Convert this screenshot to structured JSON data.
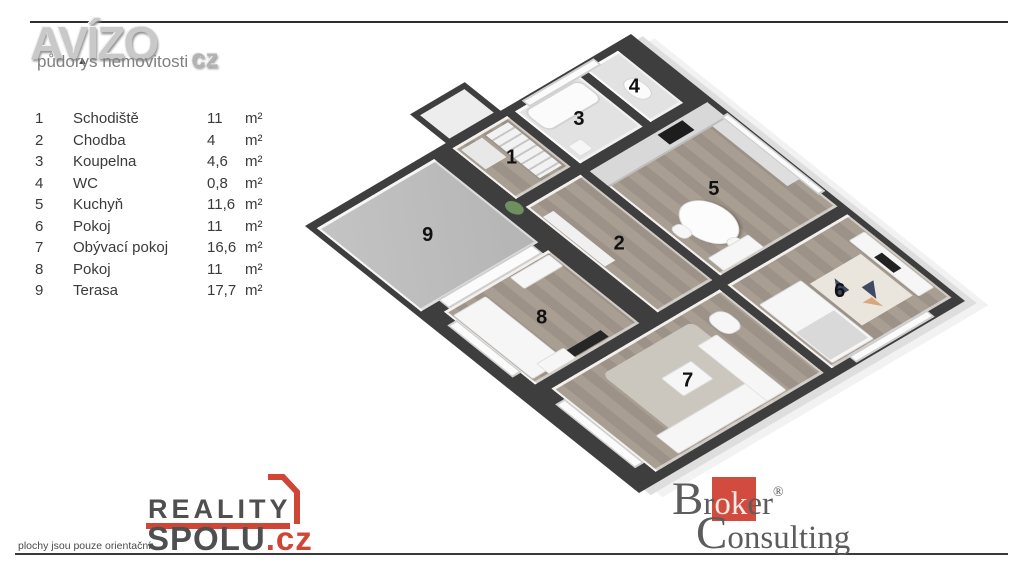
{
  "header": {
    "brand": "AVÍZO",
    "brand_suffix": "cz",
    "subtitle": "půdorys nemovitosti",
    "accent_triangle": "▲"
  },
  "legend": {
    "rows": [
      {
        "num": "1",
        "name": "Schodiště",
        "value": "11",
        "unit": "m²"
      },
      {
        "num": "2",
        "name": "Chodba",
        "value": "4",
        "unit": "m²"
      },
      {
        "num": "3",
        "name": "Koupelna",
        "value": "4,6",
        "unit": "m²"
      },
      {
        "num": "4",
        "name": "WC",
        "value": "0,8",
        "unit": "m²"
      },
      {
        "num": "5",
        "name": "Kuchyň",
        "value": "11,6",
        "unit": "m²"
      },
      {
        "num": "6",
        "name": "Pokoj",
        "value": "11",
        "unit": "m²"
      },
      {
        "num": "7",
        "name": "Obývací pokoj",
        "value": "16,6",
        "unit": "m²"
      },
      {
        "num": "8",
        "name": "Pokoj",
        "value": "11",
        "unit": "m²"
      },
      {
        "num": "9",
        "name": "Terasa",
        "value": "17,7",
        "unit": "m²"
      }
    ]
  },
  "plan": {
    "labels": [
      "1",
      "2",
      "3",
      "4",
      "5",
      "6",
      "7",
      "8",
      "9"
    ]
  },
  "footer": {
    "disclaimer": "plochy jsou pouze orientační",
    "reality": {
      "line1": "REALITY",
      "line2": "SPOLU",
      "tld": ".cz"
    },
    "broker": {
      "b": "B",
      "r1": "r",
      "ok": "ok",
      "r2": "er",
      "reg": "®",
      "c": "C",
      "rest": "onsulting"
    }
  },
  "colors": {
    "accent_red": "#cf4536",
    "broker_red": "#d14b3e",
    "wall_dark": "#3e3e3e",
    "wood_floor": "#a89e92",
    "terrace_concrete": "#bdbdbd",
    "logo_grey": "#c9c9c9",
    "text_dark": "#3a3a3a"
  }
}
